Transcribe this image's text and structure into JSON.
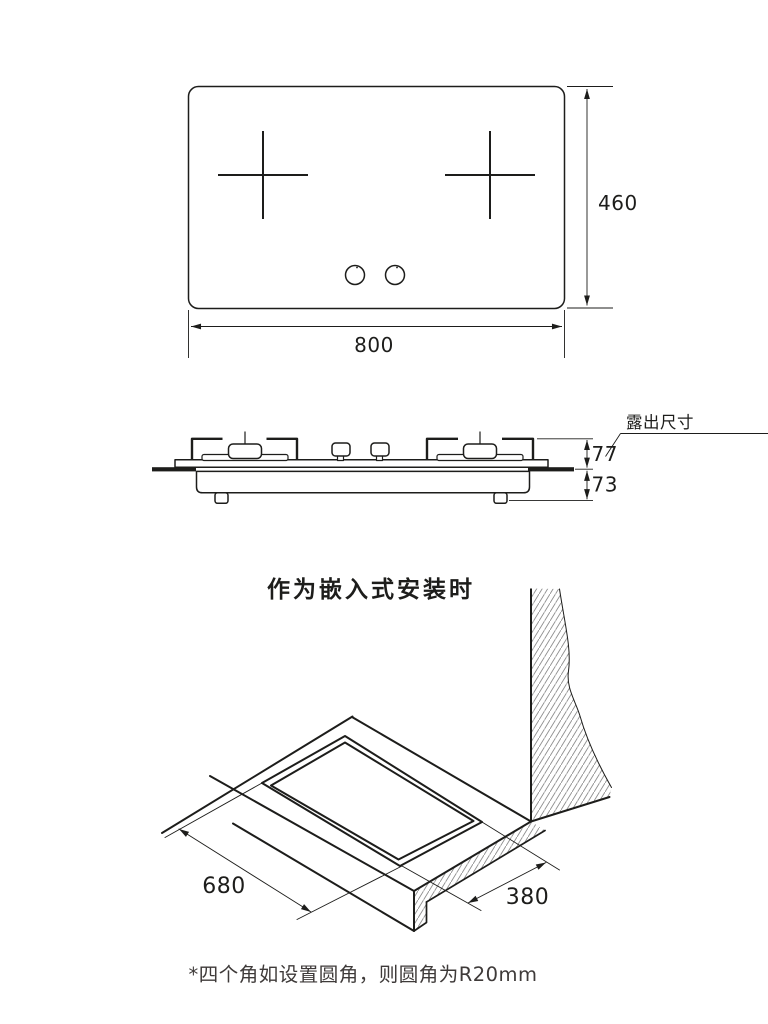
{
  "top_view": {
    "width_mm": "800",
    "height_mm": "460"
  },
  "side_view": {
    "callout": "露出尺寸",
    "above_counter_mm": "77",
    "below_counter_mm": "73"
  },
  "installation": {
    "heading": "作为嵌入式安装时",
    "cutout_length_mm": "680",
    "cutout_depth_mm": "380",
    "note": "*四个角如设置圆角，则圆角为R20mm"
  },
  "colors": {
    "line": "#1d1d1b",
    "note_text": "#3e3a39",
    "hatch": "#8f8f8f",
    "background": "#ffffff"
  }
}
